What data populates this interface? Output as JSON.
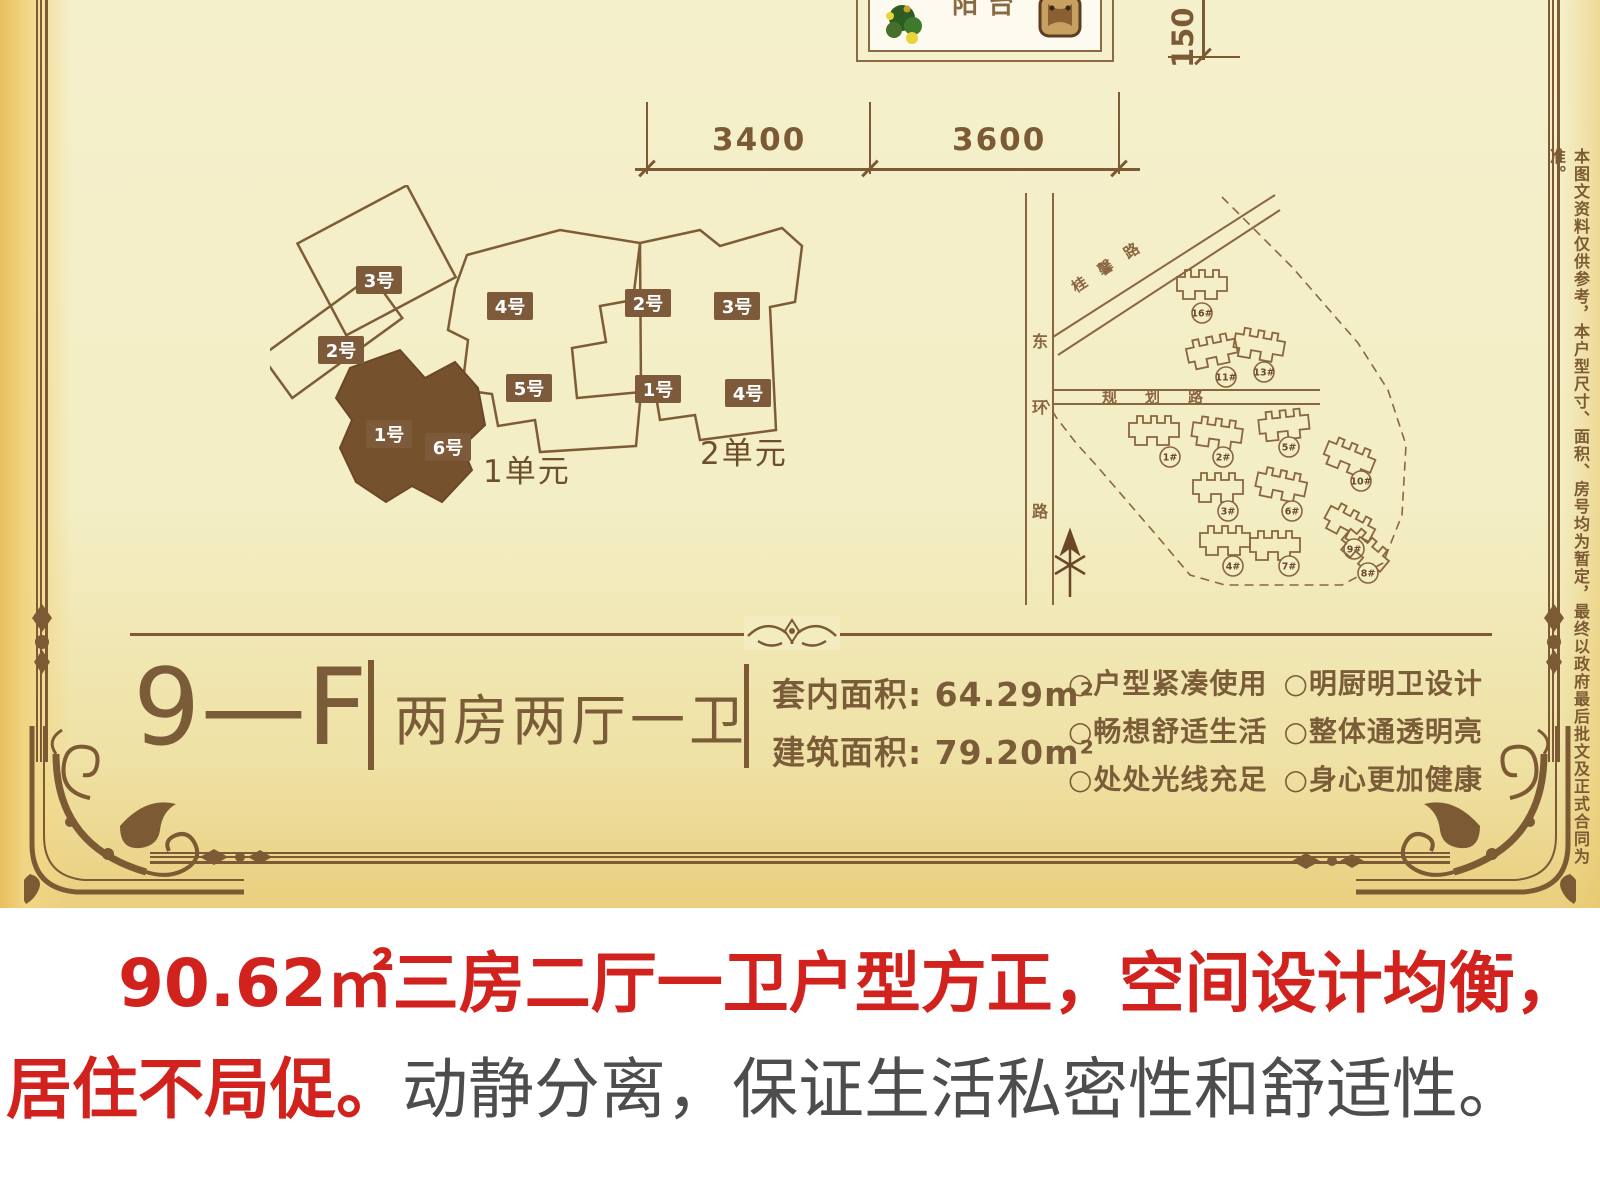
{
  "colors": {
    "brown": "#7b5a34",
    "brown_dark": "#6e4f2c",
    "chip_bg": "#7d5a39",
    "solid_fill": "#76512e",
    "red": "#d2221e",
    "gray": "#4d4d4d",
    "cream": "#f3eec6"
  },
  "floorplan": {
    "balcony_label": "阳台",
    "dims": {
      "h1": "3400",
      "h2": "3600",
      "v": "150"
    }
  },
  "keyplan": {
    "unit1": "1单元",
    "unit2": "2单元",
    "chips": [
      {
        "t": "3号",
        "x": 356,
        "y": 266
      },
      {
        "t": "2号",
        "x": 318,
        "y": 336
      },
      {
        "t": "4号",
        "x": 487,
        "y": 292
      },
      {
        "t": "5号",
        "x": 506,
        "y": 374
      },
      {
        "t": "1号",
        "x": 366,
        "y": 420
      },
      {
        "t": "6号",
        "x": 425,
        "y": 433
      },
      {
        "t": "2号",
        "x": 625,
        "y": 289
      },
      {
        "t": "3号",
        "x": 714,
        "y": 292
      },
      {
        "t": "1号",
        "x": 635,
        "y": 375
      },
      {
        "t": "4号",
        "x": 725,
        "y": 379
      }
    ]
  },
  "siteplan": {
    "road_v": "东环路",
    "road_d": "桂馨路",
    "road_h": "规划路",
    "buildings": [
      {
        "no": "16#",
        "gx": 215,
        "gy": 100,
        "lx": 212,
        "ly": 128
      },
      {
        "no": "11#",
        "gx": 225,
        "gy": 166,
        "lx": 236,
        "ly": 192
      },
      {
        "no": "13#",
        "gx": 272,
        "gy": 161,
        "lx": 274,
        "ly": 187
      },
      {
        "no": "1#",
        "gx": 167,
        "gy": 246,
        "lx": 180,
        "ly": 272
      },
      {
        "no": "2#",
        "gx": 230,
        "gy": 249,
        "lx": 233,
        "ly": 272
      },
      {
        "no": "5#",
        "gx": 297,
        "gy": 240,
        "lx": 299,
        "ly": 262
      },
      {
        "no": "10#",
        "gx": 362,
        "gy": 274,
        "lx": 371,
        "ly": 296
      },
      {
        "no": "3#",
        "gx": 231,
        "gy": 303,
        "lx": 238,
        "ly": 326
      },
      {
        "no": "6#",
        "gx": 294,
        "gy": 301,
        "lx": 302,
        "ly": 326
      },
      {
        "no": "9#",
        "gx": 362,
        "gy": 341,
        "lx": 364,
        "ly": 364
      },
      {
        "no": "4#",
        "gx": 238,
        "gy": 356,
        "lx": 243,
        "ly": 381
      },
      {
        "no": "7#",
        "gx": 288,
        "gy": 361,
        "lx": 299,
        "ly": 381
      },
      {
        "no": "8#",
        "gx": 377,
        "gy": 368,
        "lx": 378,
        "ly": 388
      }
    ]
  },
  "disclaimer": "本图文资料仅供参考，本户型尺寸、面积、房号均为暂定，最终以政府最后批文及正式合同为准。",
  "info": {
    "code": "9—F",
    "type": "两房两厅一卫",
    "areas": [
      {
        "label": "套内面积:",
        "value": "64.29m²"
      },
      {
        "label": "建筑面积:",
        "value": "79.20m²"
      }
    ],
    "features": [
      "○户型紧凑使用",
      "○明厨明卫设计",
      "○畅想舒适生活",
      "○整体通透明亮",
      "○处处光线充足",
      "○身心更加健康"
    ]
  },
  "caption": {
    "line1": "90.62㎡三房二厅一卫户型方正，空间设计均衡，",
    "line2_red": "居住不局促。",
    "line2_gray": "动静分离，保证生活私密性和舒适性。"
  }
}
